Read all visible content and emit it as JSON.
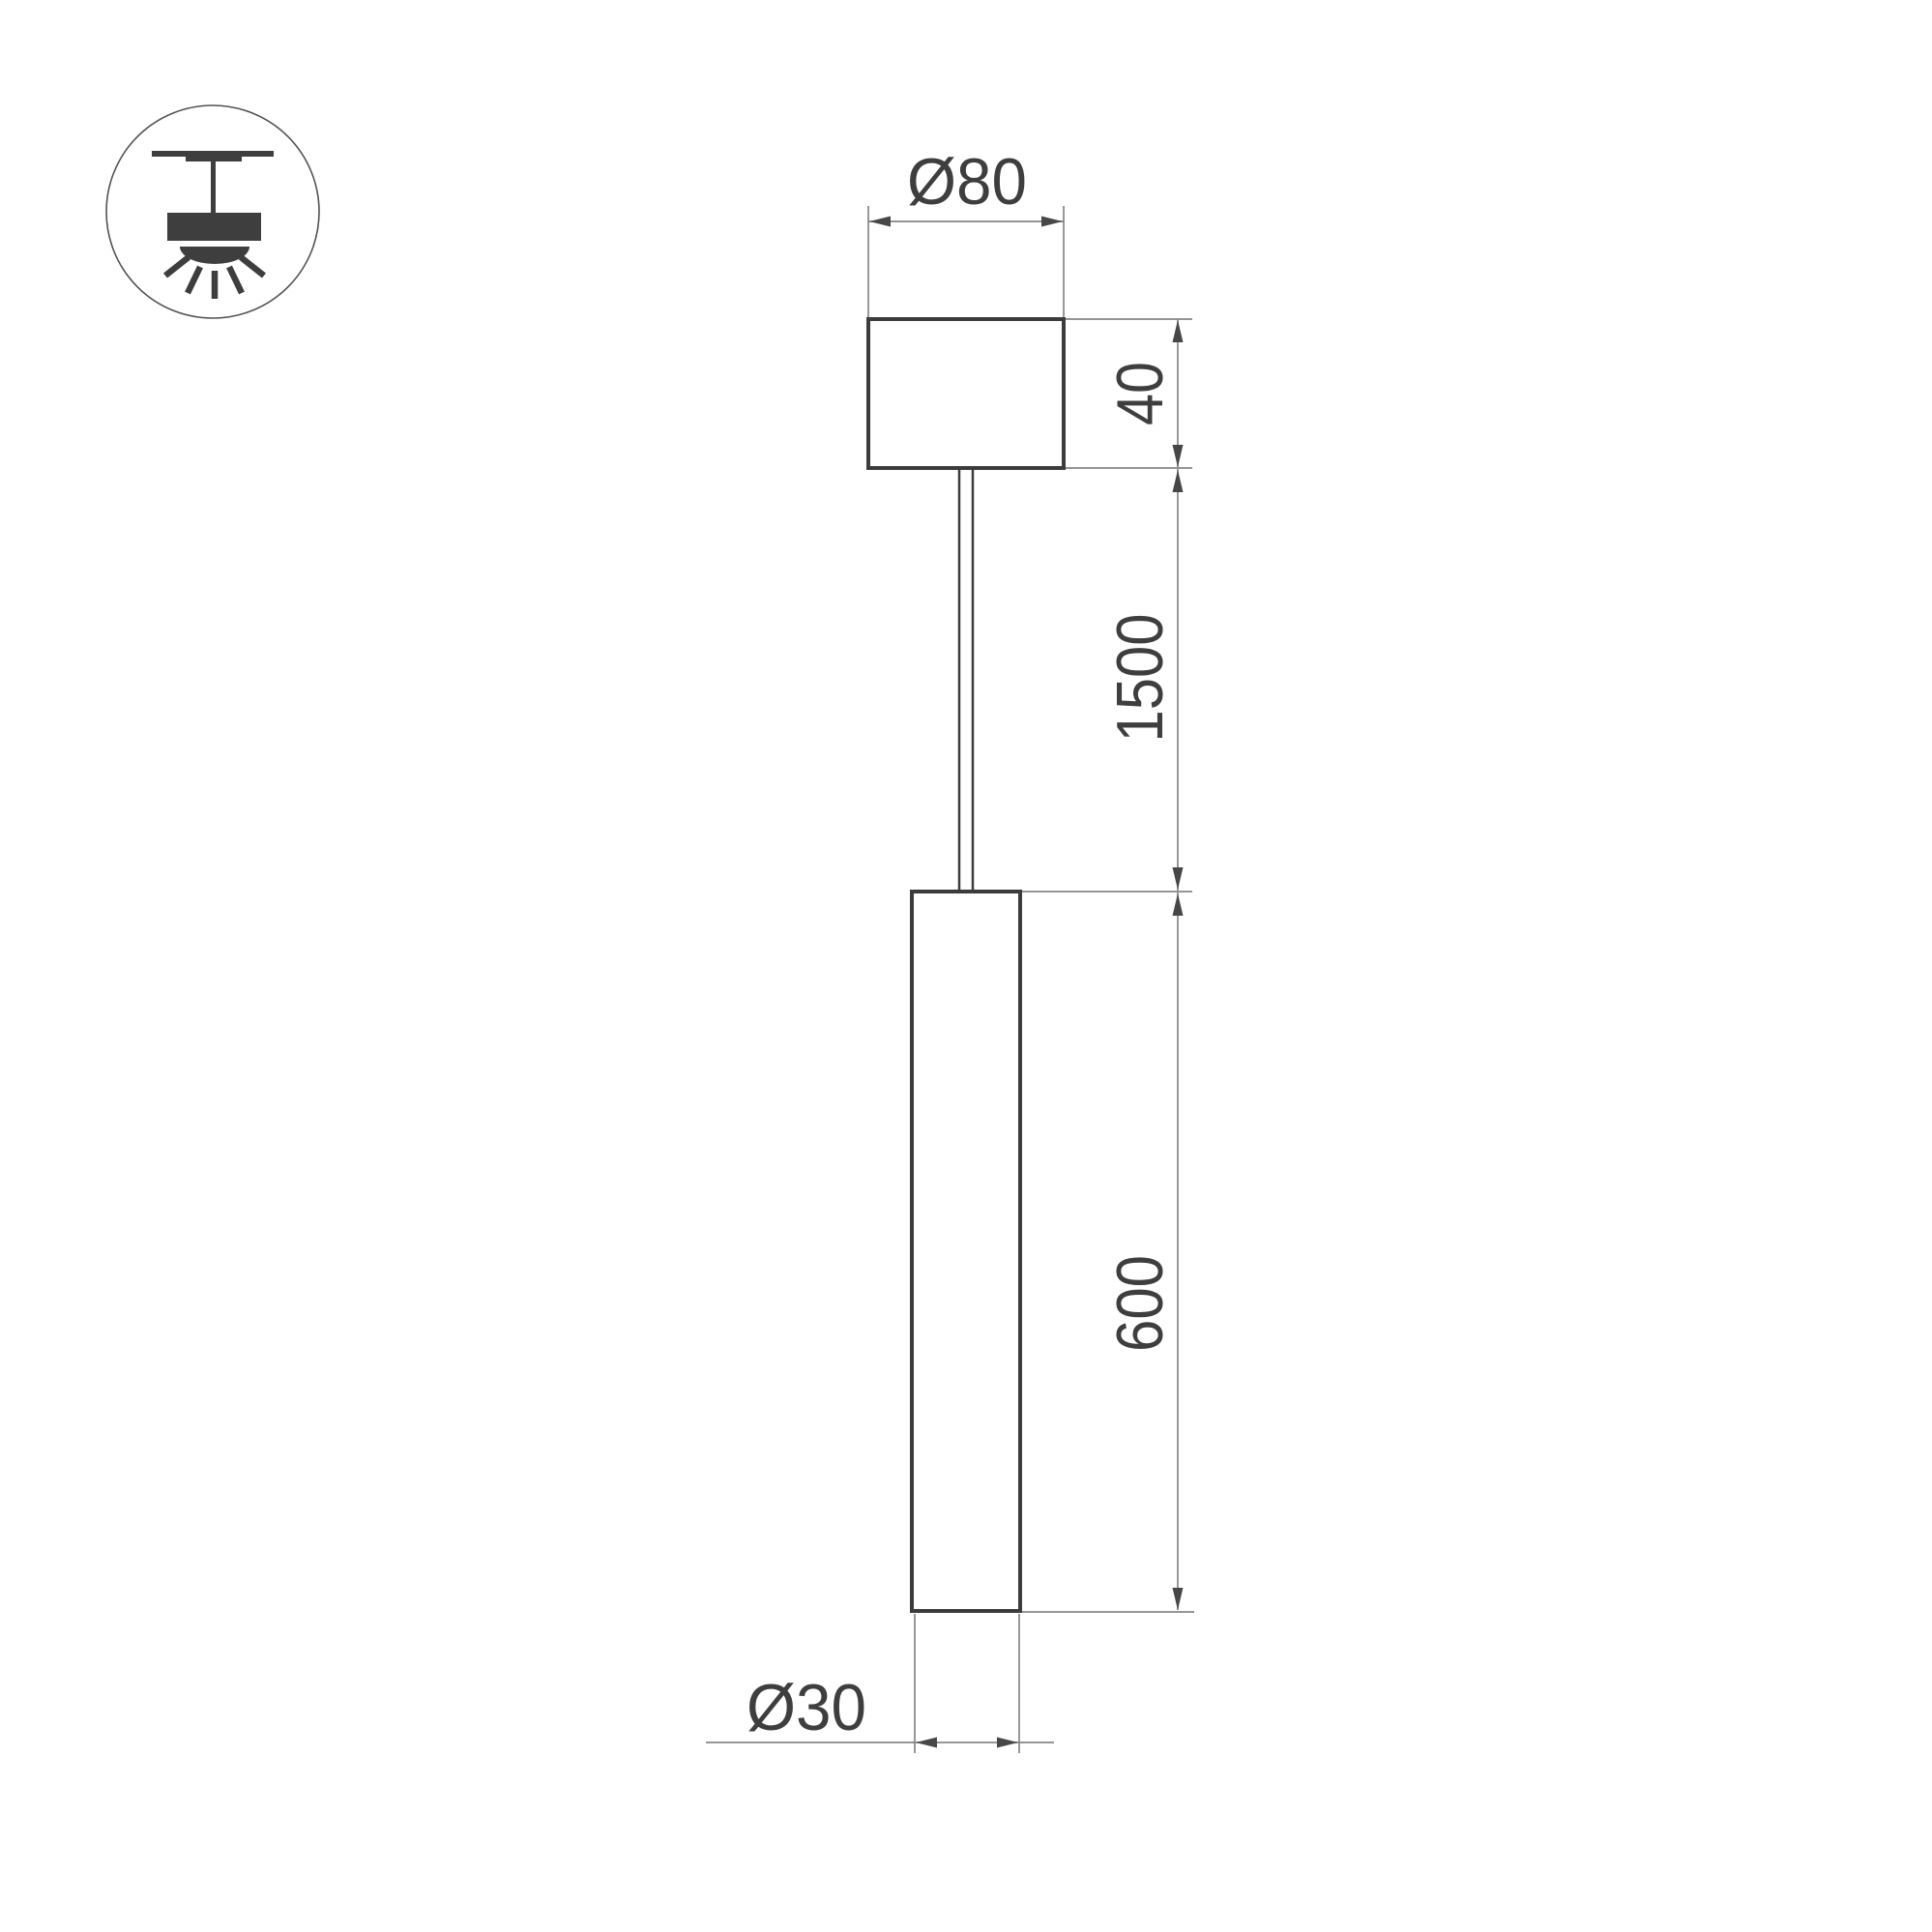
{
  "icon": {
    "name": "ceiling-pendant-mount-icon"
  },
  "labels": {
    "canopy_diameter": "Ø80",
    "canopy_height": "40",
    "suspension_length": "1500",
    "tube_length": "600",
    "tube_diameter": "Ø30"
  },
  "colors": {
    "outline": "#3c3c3c",
    "dimension": "#868686",
    "arrow": "#474747",
    "text": "#3e3e3e",
    "icon": "#3e3e3e",
    "icon_circle": "#525252",
    "background": "#ffffff"
  }
}
